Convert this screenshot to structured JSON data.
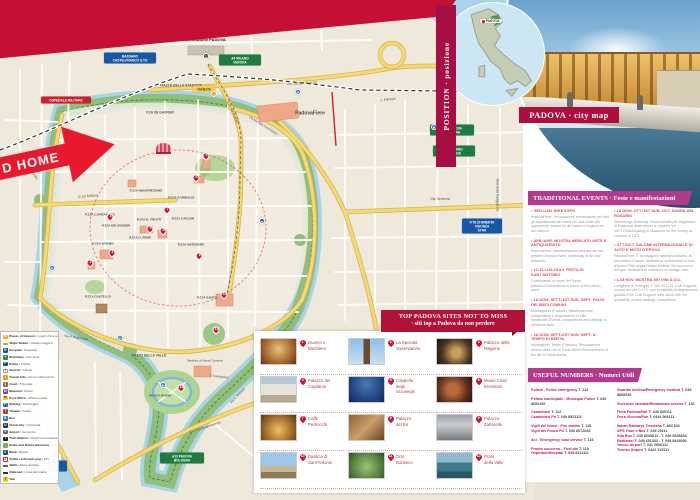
{
  "banners": {
    "position_label": "POSITION · posizione",
    "city_map_label": "PADOVA · city map",
    "inset_marker": "PADOVA",
    "events_header": "TRADITIONAL EVENTS · Feste e manifestazioni",
    "numbers_header": "USEFUL NUMBERS · Numeri Utili",
    "sites_header_line1": "TOP PADOVA SITES NOT TO MISS",
    "sites_header_line2": "· siti  top a Padova da non perdere",
    "home_arrow": "D HOME"
  },
  "colors": {
    "crimson": "#c60f35",
    "raspberry": "#a50f44",
    "magenta": "#b23a8c",
    "map_green": "#8fbf7a",
    "water_blue": "#a9d3ea",
    "road_yellow": "#f5d976",
    "pin_red": "#d01536"
  },
  "events": {
    "columns": [
      [
        {
          "title": "GEN./JAN. BIKE EXPO",
          "body": "PadovaFiere. Un'occasione immancabile per tutti gli appassionati dei motori su due ruote./An opportunity missed for all lovers of engines on two wheels."
        },
        {
          "title": "APR./APR. MOSTRA MERCATO ARTE E ANTIQUARIATO",
          "body": "PadovaFiere. Manifestazione annuale da non perdere./Annual event, Anthology of Art and Antiques."
        },
        {
          "title": "12-13 LUG./JULY. FESTA DI SANT'ANTONIO",
          "body": "Celebrazioni in onore del Santo patrono./Celebrations in honor of the patron saint."
        },
        {
          "title": "1A DOM. SETT./1ST SUN. SEPT. PALIO DEI DIECI COMUNI",
          "body": "Montagnana (Padova). Manifestazione, competizioni e degustazioni in stile medievale./Events, competitions and tastings in medieval style."
        },
        {
          "title": "2A DOM. SETT./2ST SUN. SEPT. IL TEMPO DI BERTA",
          "body": "Montegrotto Terme (Padova). Rievocazione storica della vita di Santa Berta./Reenactment of the life of Santa Berta."
        }
      ],
      [
        {
          "title": "1A DOM. OTT./1ST SUN. OCT. SAGRA DEL ROSARIO",
          "body": "Saccolongo (Padova). Festa istituita per ringraziare la Madonna della vittoria a Lepanto nel 1571./Thanksgiving to Madonna for the victory at Lepanto in 1571."
        },
        {
          "title": "OTT./OCT. SALONE INTERNAZIONALE DI AUTO E MOTO D'EPOCA",
          "body": "PadovaFiere. È la maggiore rassegna italiana, la seconda in Europa, dedicata ai collezionisti di auto d'epoca./The largest Italian festival, the second in Europe, dedicated to collectors of vintage cars."
        },
        {
          "title": "1-15 NOV. MOSTRA DEI VINI D.O.C.",
          "body": "Luvigliano di Torreglia, T. 049 521133. Colli Euganei: mostra dei vini D.O.C. con possibilità di degustazioni guidate./The Colli Euganei wine show with the possibility of wine tastings, competition."
        }
      ]
    ]
  },
  "useful_numbers": {
    "columns": [
      [
        [
          {
            "l": "Polizia - Police emergency",
            "n": "T. 113"
          }
        ],
        [
          {
            "l": "Polizia municipale - Municipal Police",
            "n": "T. 049 8205100"
          }
        ],
        [
          {
            "l": "Carabinieri",
            "n": "T. 112"
          },
          {
            "l": "Carabinieri Pd",
            "n": "T. 049 8521111"
          }
        ],
        [
          {
            "l": "Vigili del fuoco - Fire station",
            "n": "T. 115"
          },
          {
            "l": "Vigili del Fuoco Pd",
            "n": "T. 049 8072045"
          }
        ],
        [
          {
            "l": "Aci - Emergency road service",
            "n": "T. 116"
          }
        ],
        [
          {
            "l": "Pronto soccorso - First aid",
            "n": "T. 118"
          },
          {
            "l": "Ospedale/Hospital",
            "n": "T. 049 8211111"
          }
        ]
      ],
      [
        [
          {
            "l": "Guardia medica/Emergency medical",
            "n": "T. 049 8808325"
          }
        ],
        [
          {
            "l": "Soccorso stradale/Breakdown service",
            "n": "T. 116"
          }
        ],
        [
          {
            "l": "Fiera Padova/Fair",
            "n": "T. 049 840111"
          },
          {
            "l": "Fiera Vicenza/Fair",
            "n": "T. 0444 969111"
          }
        ],
        [
          {
            "l": "Italian Railways Trenitalia",
            "n": "T. 892 021"
          },
          {
            "l": "APS Tram e Bus",
            "n": "T. 049 20111"
          },
          {
            "l": "Sita Bus",
            "n": "T. 049 8206811 - T. 049 8206834"
          },
          {
            "l": "Radiotaxi",
            "n": "T. 049 651333 - T. 049 8443000"
          },
          {
            "l": "Venice Airport",
            "n": "T. 041 2606111"
          },
          {
            "l": "Treviso Airport",
            "n": "T. 0422 315111"
          }
        ]
      ]
    ]
  },
  "sites": {
    "items": [
      {
        "num": "1",
        "label": "Duomo e\nBattistero"
      },
      {
        "num": "2",
        "label": "La Specola\nOsservatorio"
      },
      {
        "num": "3",
        "label": "Palazzo della\nRagione"
      },
      {
        "num": "4",
        "label": "Palazzo del\nCapitanio"
      },
      {
        "num": "5",
        "label": "Cappella\ndegli\nScrovegni"
      },
      {
        "num": "6",
        "label": "Musei Civici\nEremitani"
      },
      {
        "num": "7",
        "label": "Caffè\nPedrocchi"
      },
      {
        "num": "8",
        "label": "Palazzo\ndel Bò"
      },
      {
        "num": "9",
        "label": "Palazzo\nZabarella"
      },
      {
        "num": "10",
        "label": "Basilica di\nSant'Antonio"
      },
      {
        "num": "11",
        "label": "Orto\nBotanico"
      },
      {
        "num": "12",
        "label": "Prato\ndella Valle"
      }
    ]
  },
  "legend": {
    "items": [
      {
        "en": "Places of interest",
        "it": "Luoghi d'interesse",
        "bg": "#f0a83c",
        "g": "★",
        "fg": "#fff"
      },
      {
        "en": "Major Roads",
        "it": "Strade maggiori",
        "shape": "bar",
        "bg": "#f2cf5a",
        "bd": "#c9a23a"
      },
      {
        "en": "Hospital",
        "it": "Ospedale",
        "bg": "#1d4f9e",
        "g": "H",
        "fg": "#fff"
      },
      {
        "en": "Pharmacy",
        "it": "Farmacia",
        "bg": "#2e8b3a",
        "g": "+",
        "fg": "#fff"
      },
      {
        "en": "Police",
        "it": "Polizia",
        "bg": "#20457e",
        "g": "P",
        "fg": "#fff"
      },
      {
        "en": "Church",
        "it": "Chiesa",
        "bg": "#ffffff",
        "g": "†",
        "fg": "#333",
        "bd": "#999"
      },
      {
        "en": "Tourist Info",
        "it": "Punto informazioni",
        "bg": "#e8a020",
        "g": "i",
        "fg": "#fff"
      },
      {
        "en": "Court",
        "it": "Tribunale",
        "bg": "#8a6a4a",
        "g": "§",
        "fg": "#fff"
      },
      {
        "en": "Museum",
        "it": "Musei",
        "bg": "#7a4a8a",
        "g": "M",
        "fg": "#fff"
      },
      {
        "en": "Post Office",
        "it": "Ufficio postale",
        "bg": "#f5c518",
        "g": "✉",
        "fg": "#333"
      },
      {
        "en": "Parking",
        "it": "Parcheggio",
        "bg": "#1d6fd0",
        "g": "P",
        "fg": "#fff"
      },
      {
        "en": "Theater",
        "it": "Teatro",
        "bg": "#c0392b",
        "g": "T",
        "fg": "#fff"
      },
      {
        "en": "Bus",
        "it": "",
        "bg": "#2a7ab8",
        "g": "B",
        "fg": "#fff"
      },
      {
        "en": "University",
        "it": "Università",
        "bg": "#333333",
        "g": "U",
        "fg": "#fff"
      },
      {
        "en": "Airport",
        "it": "Aeroporto",
        "bg": "#666666",
        "g": "✈",
        "fg": "#fff"
      },
      {
        "en": "Train Station",
        "it": "Stazione ferroviaria",
        "bg": "#222222",
        "g": "T",
        "fg": "#fff"
      },
      {
        "en": "Parks and Nature Reserves",
        "it": "",
        "bg": "#7ab05c",
        "g": "",
        "fg": "#fff"
      },
      {
        "en": "Bank",
        "it": "Banca",
        "bg": "#1a5276",
        "g": "€",
        "fg": "#fff"
      },
      {
        "en": "Traffic restricted zone",
        "it": "ZTL",
        "bg": "#ffffff",
        "g": "●",
        "fg": "#d02030",
        "bd": "#d02030"
      },
      {
        "en": "Walls",
        "it": "Mura storiche",
        "shape": "bar",
        "bg": "#a0785a",
        "bd": "#7a5a40"
      },
      {
        "en": "Railroad",
        "it": "Linea ferroviaria",
        "shape": "rail"
      },
      {
        "en": "Taxi",
        "it": "",
        "bg": "#f5c518",
        "g": "T",
        "fg": "#333"
      }
    ]
  },
  "map": {
    "labels": [
      {
        "t": "Train Station/Stazione PADOVA",
        "x": 196,
        "y": 40,
        "s": 4,
        "b": 1,
        "c": "#222"
      },
      {
        "t": "PIAZZA DELLA STAZIONE",
        "x": 181,
        "y": 86,
        "s": 3.4,
        "b": 1,
        "c": "#555"
      },
      {
        "t": "P.ZA DE GASPERI",
        "x": 160,
        "y": 113,
        "s": 3.2,
        "b": 1,
        "c": "#555"
      },
      {
        "t": "Via Jacopo Avanzo",
        "x": 302,
        "y": 84,
        "s": 3.6,
        "r": -3,
        "c": "#6b5a2a"
      },
      {
        "t": "PadovaFiere",
        "x": 310,
        "y": 114,
        "s": 5,
        "b": 1,
        "c": "#4a4a4a"
      },
      {
        "t": "Via Niccolò Tommaseo",
        "x": 263,
        "y": 126,
        "s": 3.3,
        "r": 32,
        "c": "#6b5a2a"
      },
      {
        "t": "C.so Milano",
        "x": 88,
        "y": 197,
        "s": 3.8,
        "r": -4,
        "c": "#6b5a2a"
      },
      {
        "t": "P.ZZA INSURREZIONE",
        "x": 146,
        "y": 191,
        "s": 3.1,
        "b": 1
      },
      {
        "t": "P.ZZA GARIBALDI",
        "x": 181,
        "y": 198,
        "s": 3.1,
        "b": 1
      },
      {
        "t": "P.ZZA CAPITANIATO",
        "x": 100,
        "y": 215,
        "s": 3.1,
        "b": 1
      },
      {
        "t": "P.ZZA DEI SIGNORI",
        "x": 116,
        "y": 226,
        "s": 3.1,
        "b": 1
      },
      {
        "t": "P.ZZA D. FRUTTI",
        "x": 149,
        "y": 220,
        "s": 3.1,
        "b": 1
      },
      {
        "t": "P.ZZA CAVOUR",
        "x": 183,
        "y": 219,
        "s": 3.1,
        "b": 1
      },
      {
        "t": "P.ZZA D. ERBE",
        "x": 140,
        "y": 238,
        "s": 3.1,
        "b": 1
      },
      {
        "t": "P.ZZA DUOMO",
        "x": 103,
        "y": 244,
        "s": 3.1,
        "b": 1
      },
      {
        "t": "P.ZZA ANTENORE",
        "x": 191,
        "y": 245,
        "s": 3.1,
        "b": 1
      },
      {
        "t": "P.ZZA CASTELLO",
        "x": 98,
        "y": 297,
        "s": 3.1,
        "b": 1
      },
      {
        "t": "P.ZZA SANTO",
        "x": 207,
        "y": 298,
        "s": 3.1,
        "b": 1
      },
      {
        "t": "PRATO DELLA VALLE",
        "x": 149,
        "y": 356,
        "s": 3.3,
        "b": 1,
        "c": "#3d6e35"
      },
      {
        "t": "Basilica di Santa Giustina",
        "x": 205,
        "y": 361,
        "s": 3.1
      },
      {
        "t": "PIAZZA RABIN",
        "x": 160,
        "y": 396,
        "s": 3.1,
        "b": 1
      },
      {
        "t": "Via Savonarola",
        "x": 30,
        "y": 170,
        "s": 3.4,
        "r": 55,
        "c": "#6b5a2a"
      },
      {
        "t": "Via P. Paleocapa",
        "x": 76,
        "y": 338,
        "s": 3.2,
        "r": 8
      },
      {
        "t": "Via Goito",
        "x": 54,
        "y": 428,
        "s": 3.4,
        "r": 72,
        "c": "#6b5a2a"
      },
      {
        "t": "V.le D'Acquapendente",
        "x": 205,
        "y": 428,
        "s": 3.4,
        "r": -18,
        "c": "#6b5a2a"
      },
      {
        "t": "Via A. Memmo",
        "x": 238,
        "y": 396,
        "s": 3.1,
        "r": -46
      },
      {
        "t": "V. Cavazzana",
        "x": 219,
        "y": 377,
        "s": 3.1,
        "r": 6
      },
      {
        "t": "Via Venezia",
        "x": 440,
        "y": 200,
        "s": 3.8,
        "c": "#6b5a2a"
      },
      {
        "t": "V. Friburgo",
        "x": 388,
        "y": 100,
        "s": 3.2,
        "r": -8
      },
      {
        "t": "Viale della Navigazione",
        "x": 497,
        "y": 195,
        "s": 3.2,
        "r": 90
      },
      {
        "t": "Via T. Aspetti",
        "x": 145,
        "y": 30,
        "s": 3.4,
        "r": 84,
        "c": "#6b5a2a"
      },
      {
        "t": "C.so del Popolo",
        "x": 232,
        "y": 112,
        "s": 3.4,
        "r": 68,
        "c": "#6b5a2a"
      }
    ],
    "signs": [
      {
        "type": "green",
        "text": "A4 MILANO\nVERONA",
        "x": 240,
        "y": 60,
        "w": 42
      },
      {
        "type": "green",
        "text": "A13 PADOVA\nBOLOGNA",
        "x": 452,
        "y": 130,
        "w": 44
      },
      {
        "type": "green",
        "text": "A4 MILANO\nVENEZIA",
        "x": 454,
        "y": 151,
        "w": 42
      },
      {
        "type": "green",
        "text": "A13 PADOVA\nBOLOGNA",
        "x": 182,
        "y": 458,
        "w": 44
      },
      {
        "type": "blue",
        "text": "BASSANO\nCASTELFRANCO S.TO",
        "x": 130,
        "y": 58,
        "w": 52
      },
      {
        "type": "blue",
        "text": "P.TE DI BRENTA\nVIGONZA\nSTRA",
        "x": 482,
        "y": 226,
        "w": 40
      },
      {
        "type": "blue",
        "text": "ABANO TERME\nMONSELICE",
        "x": 46,
        "y": 466,
        "w": 42
      },
      {
        "type": "red",
        "text": "OSPEDALE MILITARE",
        "x": 66,
        "y": 100,
        "w": 50
      },
      {
        "type": "yellow",
        "text": "VENEZIA",
        "x": 204,
        "y": 89,
        "w": 22
      }
    ],
    "pins": [
      {
        "n": "1",
        "x": 112,
        "y": 255
      },
      {
        "n": "2",
        "x": 90,
        "y": 265
      },
      {
        "n": "3",
        "x": 150,
        "y": 231
      },
      {
        "n": "4",
        "x": 110,
        "y": 219
      },
      {
        "n": "5",
        "x": 206,
        "y": 158
      },
      {
        "n": "6",
        "x": 196,
        "y": 180
      },
      {
        "n": "7",
        "x": 167,
        "y": 212
      },
      {
        "n": "8",
        "x": 163,
        "y": 233
      },
      {
        "n": "9",
        "x": 199,
        "y": 258
      },
      {
        "n": "10",
        "x": 224,
        "y": 297
      },
      {
        "n": "11",
        "x": 216,
        "y": 332
      },
      {
        "n": "12",
        "x": 181,
        "y": 390
      }
    ],
    "icons": [
      {
        "g": "P",
        "x": 298,
        "y": 92,
        "bg": "#1d6fd0"
      },
      {
        "g": "P",
        "x": 52,
        "y": 268,
        "bg": "#1d6fd0"
      },
      {
        "g": "P",
        "x": 163,
        "y": 385,
        "bg": "#1d6fd0"
      },
      {
        "g": "P",
        "x": 434,
        "y": 127,
        "bg": "#1d6fd0"
      },
      {
        "g": "P",
        "x": 120,
        "y": 338,
        "bg": "#1d6fd0"
      },
      {
        "g": "H",
        "x": 262,
        "y": 221,
        "bg": "#1d4f9e"
      },
      {
        "g": "i",
        "x": 214,
        "y": 94,
        "bg": "#e8a020"
      },
      {
        "g": "T",
        "x": 206,
        "y": 56,
        "bg": "#333333"
      }
    ]
  }
}
